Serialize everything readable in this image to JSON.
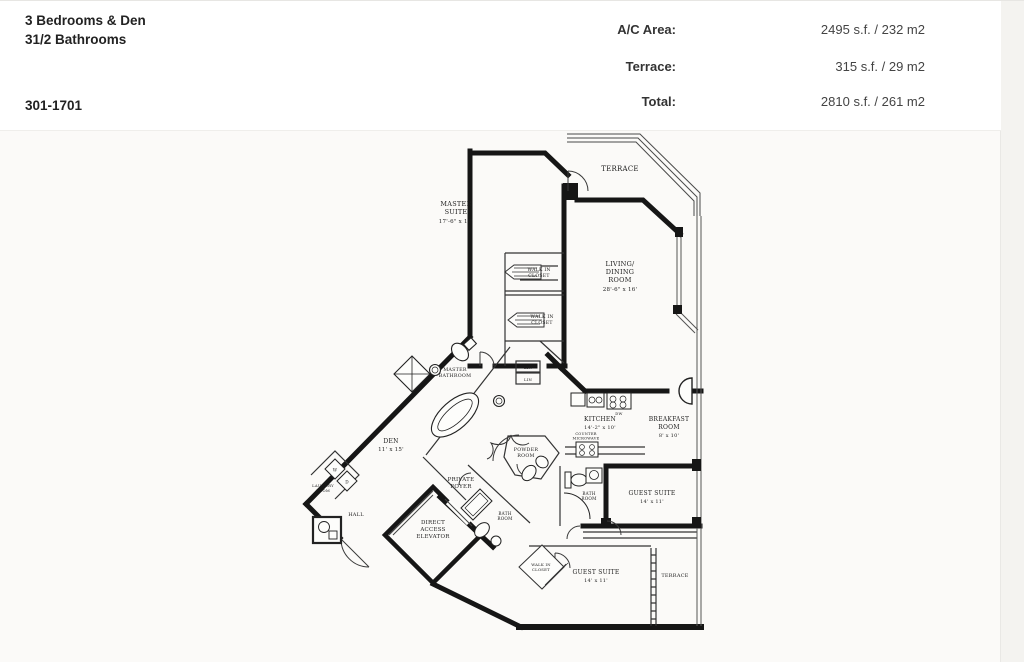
{
  "header": {
    "title_line1": "3 Bedrooms & Den",
    "title_line2": "31/2 Bathrooms",
    "unit_range": "301-1701",
    "stats": [
      {
        "label": "A/C Area:",
        "value": "2495 s.f. / 232 m2"
      },
      {
        "label": "Terrace:",
        "value": "315 s.f. / 29 m2"
      },
      {
        "label": "Total:",
        "value": "2810 s.f. / 261 m2"
      }
    ]
  },
  "floorplan": {
    "terrace_top": "TERRACE",
    "terrace_bottom": "TERRACE",
    "master_suite": {
      "l1": "MASTER",
      "l2": "SUITE",
      "dims": "17'-6\" x 17'"
    },
    "living_dining": {
      "l1": "LIVING/",
      "l2": "DINING",
      "l3": "ROOM",
      "dims": "28'-6\" x 16'"
    },
    "walk_in_closet_1": {
      "l1": "WALK IN",
      "l2": "CLOSET"
    },
    "walk_in_closet_2": {
      "l1": "WALK IN",
      "l2": "CLOSET"
    },
    "walk_in_closet_3": {
      "l1": "WALK IN",
      "l2": "CLOSET"
    },
    "master_bathroom": {
      "l1": "MASTER",
      "l2": "BATHROOM"
    },
    "lin_1": "LIN",
    "lin_2": "LIN",
    "kitchen": {
      "l1": "KITCHEN",
      "dims": "14'-2\" x 10'"
    },
    "counter_microwave": {
      "l1": "COUNTER",
      "l2": "MICROWAVE"
    },
    "dishwasher": "DW",
    "breakfast_room": {
      "l1": "BREAKFAST",
      "l2": "ROOM",
      "dims": "8' x 10'"
    },
    "den": {
      "l1": "DEN",
      "dims": "11' x 15'"
    },
    "private_foyer": {
      "l1": "PRIVATE",
      "l2": "FOYER"
    },
    "powder_room": {
      "l1": "POWDER",
      "l2": "ROOM"
    },
    "laundry_room": {
      "l1": "LAUNDRY",
      "l2": "ROOM"
    },
    "washer": "W",
    "dryer": "D",
    "hall": "HALL",
    "elevator": {
      "l1": "DIRECT",
      "l2": "ACCESS",
      "l3": "ELEVATOR"
    },
    "bath_room_1": {
      "l1": "BATH",
      "l2": "ROOM"
    },
    "bath_room_2": {
      "l1": "BATH",
      "l2": "ROOM"
    },
    "guest_suite_1": {
      "l1": "GUEST SUITE",
      "dims": "14' x 11'"
    },
    "guest_suite_2": {
      "l1": "GUEST SUITE",
      "dims": "14' x 11'"
    }
  }
}
